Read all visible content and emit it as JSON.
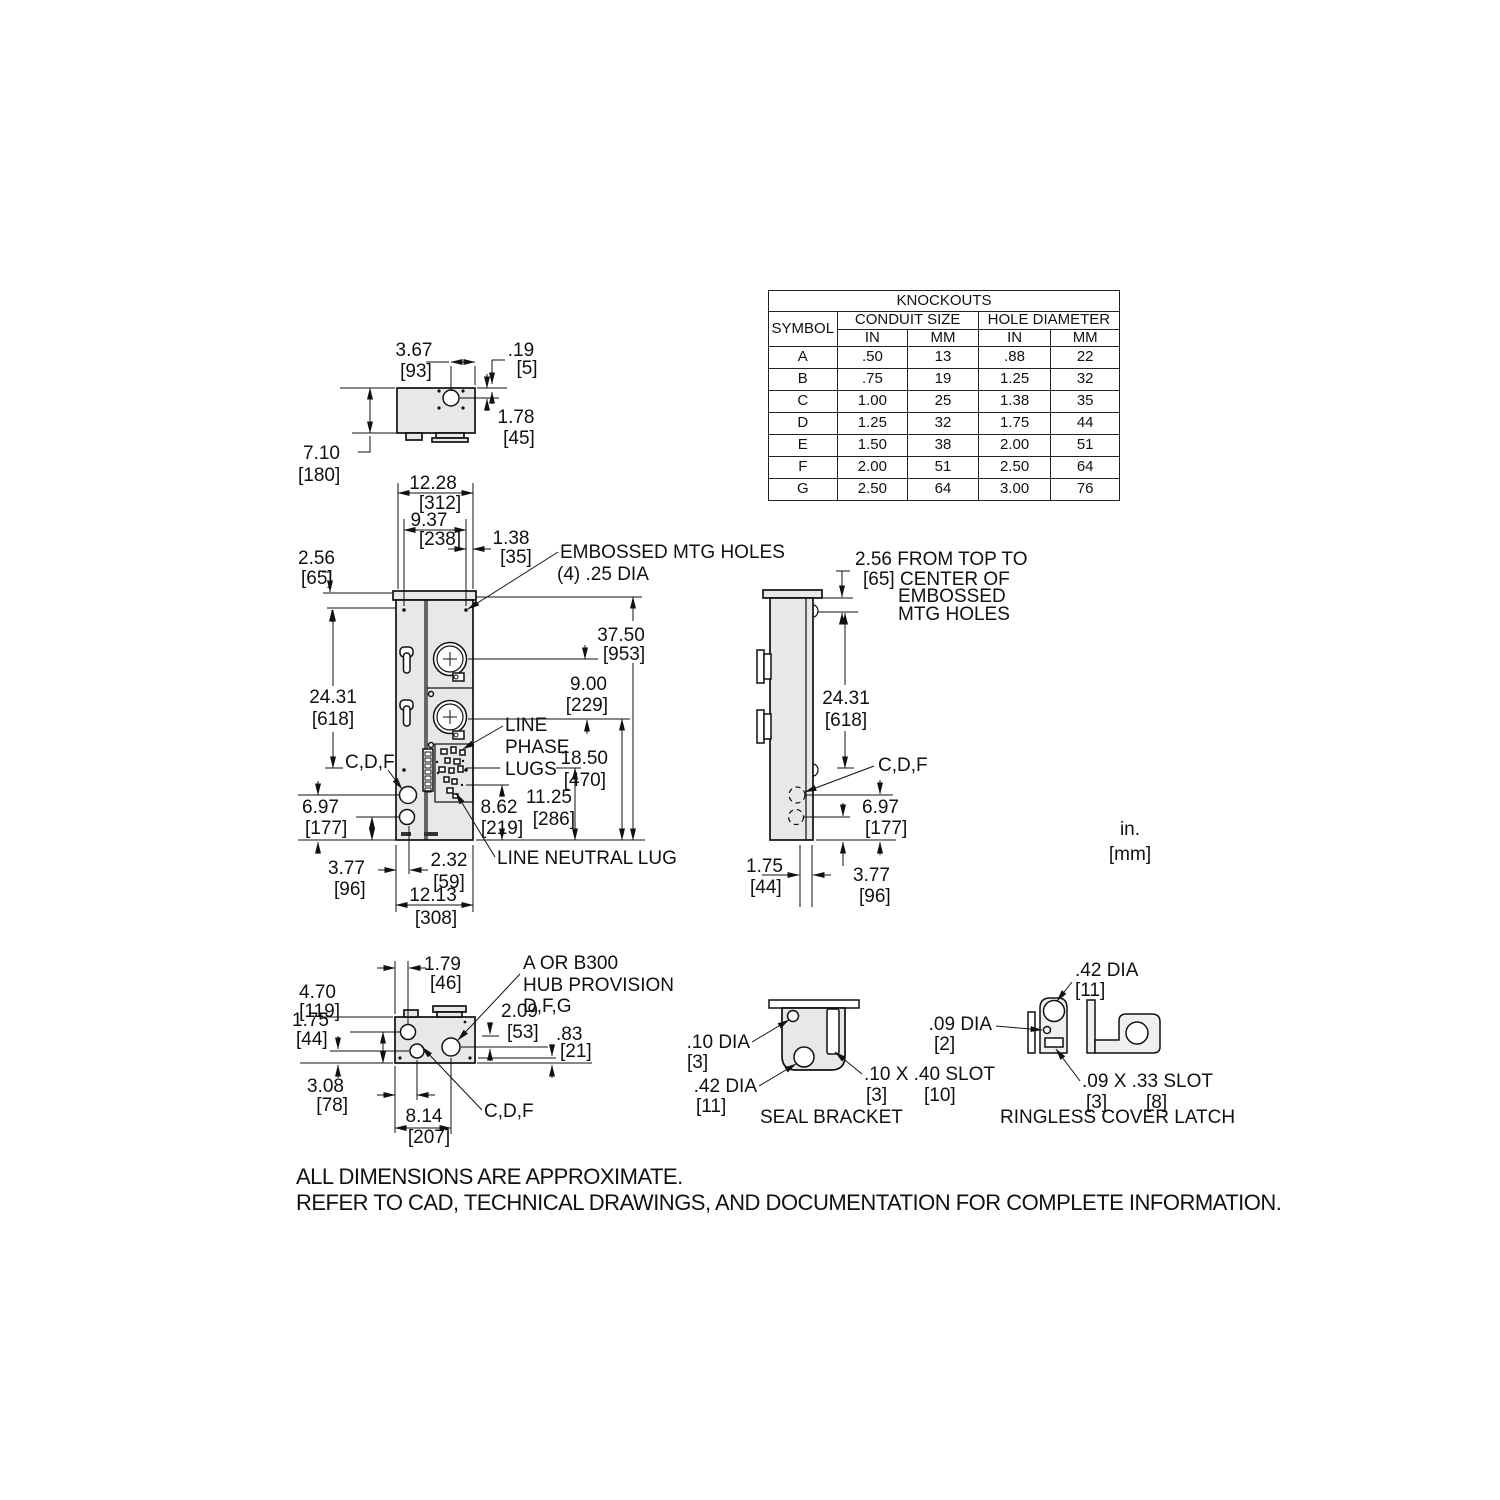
{
  "knockouts": {
    "title": "KNOCKOUTS",
    "col_symbol": "SYMBOL",
    "col_conduit": "CONDUIT SIZE",
    "col_hole": "HOLE DIAMETER",
    "col_in": "IN",
    "col_mm": "MM",
    "rows": [
      {
        "sym": "A",
        "cin": ".50",
        "cmm": "13",
        "hin": ".88",
        "hmm": "22"
      },
      {
        "sym": "B",
        "cin": ".75",
        "cmm": "19",
        "hin": "1.25",
        "hmm": "32"
      },
      {
        "sym": "C",
        "cin": "1.00",
        "cmm": "25",
        "hin": "1.38",
        "hmm": "35"
      },
      {
        "sym": "D",
        "cin": "1.25",
        "cmm": "32",
        "hin": "1.75",
        "hmm": "44"
      },
      {
        "sym": "E",
        "cin": "1.50",
        "cmm": "38",
        "hin": "2.00",
        "hmm": "51"
      },
      {
        "sym": "F",
        "cin": "2.00",
        "cmm": "51",
        "hin": "2.50",
        "hmm": "64"
      },
      {
        "sym": "G",
        "cin": "2.50",
        "cmm": "64",
        "hin": "3.00",
        "hmm": "76"
      }
    ]
  },
  "top_view": {
    "d367": "3.67",
    "d367mm": "[93]",
    "d019": ".19",
    "d019mm": "[5]",
    "d178": "1.78",
    "d178mm": "[45]",
    "d710": "7.10",
    "d710mm": "[180]"
  },
  "front_view": {
    "d1228": "12.28",
    "d1228mm": "[312]",
    "d937": "9.37",
    "d937mm": "[238]",
    "d138": "1.38",
    "d138mm": "[35]",
    "d256": "2.56",
    "d256mm": "[65]",
    "embossed1": "EMBOSSED MTG HOLES",
    "embossed2": "(4) .25 DIA",
    "d2431": "24.31",
    "d2431mm": "[618]",
    "d3750": "37.50",
    "d3750mm": "[953]",
    "d900": "9.00",
    "d900mm": "[229]",
    "phase1": "LINE",
    "phase2": "PHASE",
    "phase3": "LUGS",
    "d1850": "18.50",
    "d1850mm": "[470]",
    "d1125": "11.25",
    "d1125mm": "[286]",
    "d862": "8.62",
    "d862mm": "[219]",
    "cdf": "C,D,F",
    "d697": "6.97",
    "d697mm": "[177]",
    "d377": "3.77",
    "d377mm": "[96]",
    "d232": "2.32",
    "d232mm": "[59]",
    "d1213": "12.13",
    "d1213mm": "[308]",
    "neutral": "LINE NEUTRAL LUG"
  },
  "side_view": {
    "note1": "2.56 FROM TOP TO",
    "note2": "[65] CENTER OF",
    "note3": "EMBOSSED",
    "note4": "MTG HOLES",
    "d2431": "24.31",
    "d2431mm": "[618]",
    "cdf": "C,D,F",
    "d697": "6.97",
    "d697mm": "[177]",
    "d175": "1.75",
    "d175mm": "[44]",
    "d377": "3.77",
    "d377mm": "[96]"
  },
  "bottom_view": {
    "d179": "1.79",
    "d179mm": "[46]",
    "d470": "4.70",
    "d470mm": "[119]",
    "d175": "1.75",
    "d175mm": "[44]",
    "hub1": "A OR B300",
    "hub2": "HUB PROVISION",
    "hub3": "D,F,G",
    "d209": "2.09",
    "d209mm": "[53]",
    "d083": ".83",
    "d083mm": "[21]",
    "d308": "3.08",
    "d308mm": "[78]",
    "d814": "8.14",
    "d814mm": "[207]",
    "cdf": "C,D,F"
  },
  "seal_bracket": {
    "d010": ".10 DIA",
    "d010mm": "[3]",
    "d042": ".42 DIA",
    "d042mm": "[11]",
    "slot": ".10 X .40 SLOT",
    "slot_mm1": "[3]",
    "slot_mm2": "[10]",
    "caption": "SEAL BRACKET"
  },
  "latch": {
    "d042": ".42 DIA",
    "d042mm": "[11]",
    "d009": ".09 DIA",
    "d009mm": "[2]",
    "slot": ".09 X .33 SLOT",
    "slot_mm1": "[3]",
    "slot_mm2": "[8]",
    "caption": "RINGLESS COVER LATCH"
  },
  "units": {
    "line1": "in.",
    "line2": "[mm]"
  },
  "footer": {
    "line1": "ALL DIMENSIONS ARE APPROXIMATE.",
    "line2": "REFER TO CAD, TECHNICAL DRAWINGS, AND DOCUMENTATION FOR COMPLETE INFORMATION."
  }
}
